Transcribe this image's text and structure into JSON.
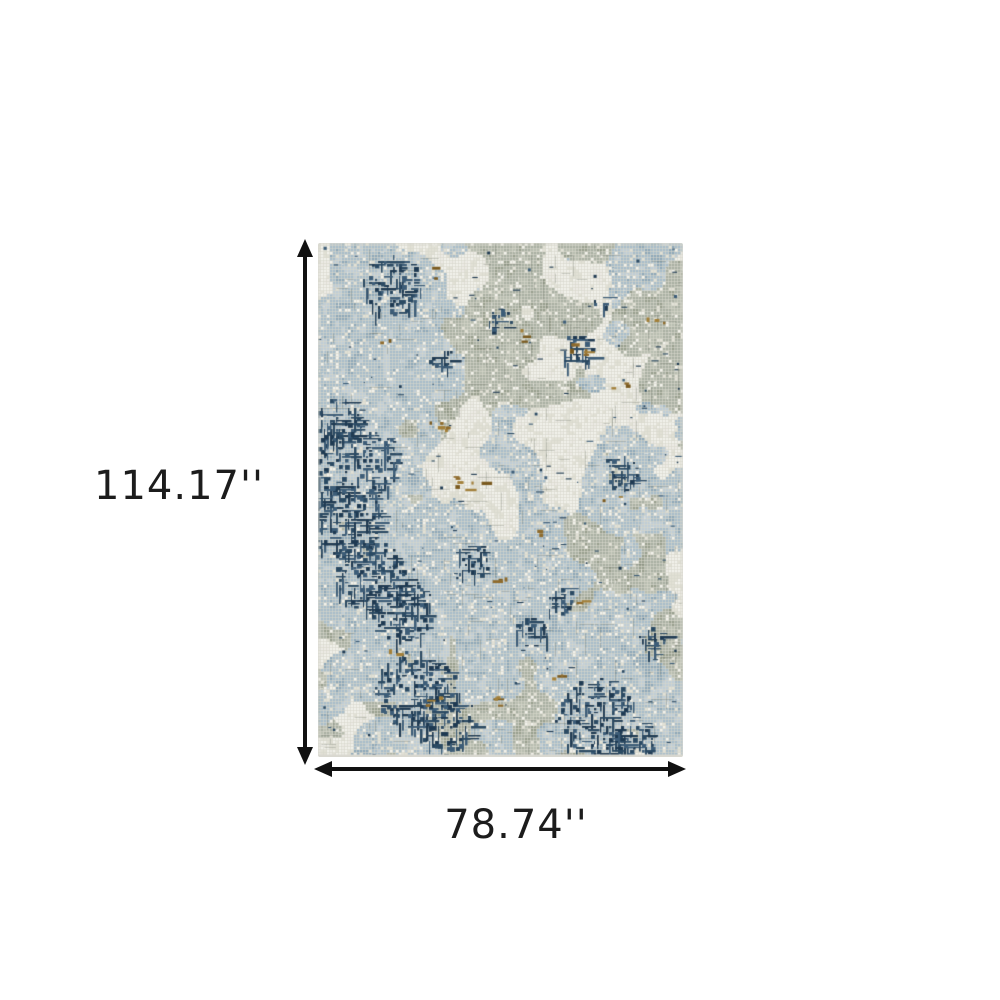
{
  "background_color": "#ffffff",
  "dimensions": {
    "height_label": "114.17''",
    "width_label": "78.74''",
    "arrow_color": "#111111",
    "label_color": "#1c1c1c"
  },
  "product": {
    "name": "abstract-area-rug",
    "description": "Abstract distressed area rug in light blue, grey green, ivory and navy with caramel accents",
    "palette": {
      "base_grid": "#d8d7cc",
      "ivory": "#edece6",
      "ivory_light": "#f3f2ec",
      "ivory_dark": "#e2e1d6",
      "light_blue": "#a7bcca",
      "pale_blue": "#bfcdd7",
      "slate_blue": "#8da7b9",
      "gray_green": "#a9afa2",
      "gray_green_light": "#b8bdb0",
      "gray_green_dark": "#979e8d",
      "gray": "#6e766a",
      "navy": "#2b4a63",
      "navy_dark": "#1f3a52",
      "navy_light": "#3d5d78",
      "caramel": "#8f6b2c",
      "caramel_light": "#a3803a",
      "caramel_dark": "#7a5a1f",
      "fringe": "#d9d8d0"
    }
  }
}
